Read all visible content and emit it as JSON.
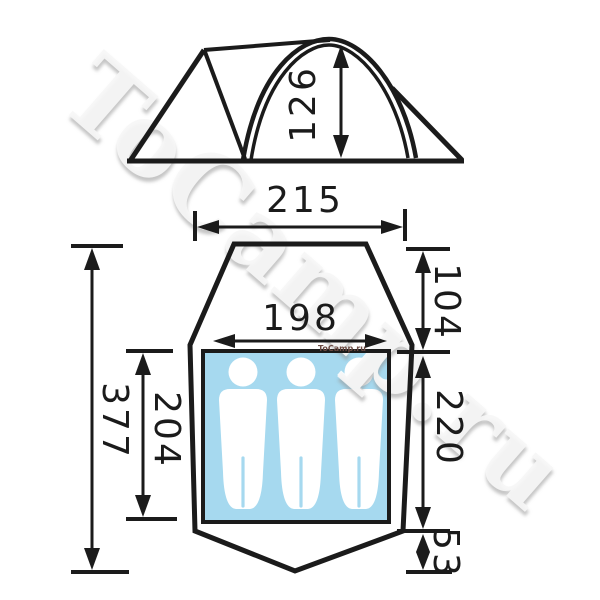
{
  "watermark": {
    "large": "ToCamp.ru",
    "small": "ToCamp.ru"
  },
  "side_view": {
    "height_label": "126"
  },
  "plan_view": {
    "outer_width_label": "215",
    "inner_width_label": "198",
    "total_length_label": "377",
    "inner_length_label": "204",
    "front_depth_label": "104",
    "inner_depth_label": "220",
    "rear_depth_label": "53",
    "capacity": 3
  },
  "colors": {
    "floor": "#a6d9ef",
    "ink": "#1b1b1b",
    "watermark_small": "#6b4a42"
  }
}
